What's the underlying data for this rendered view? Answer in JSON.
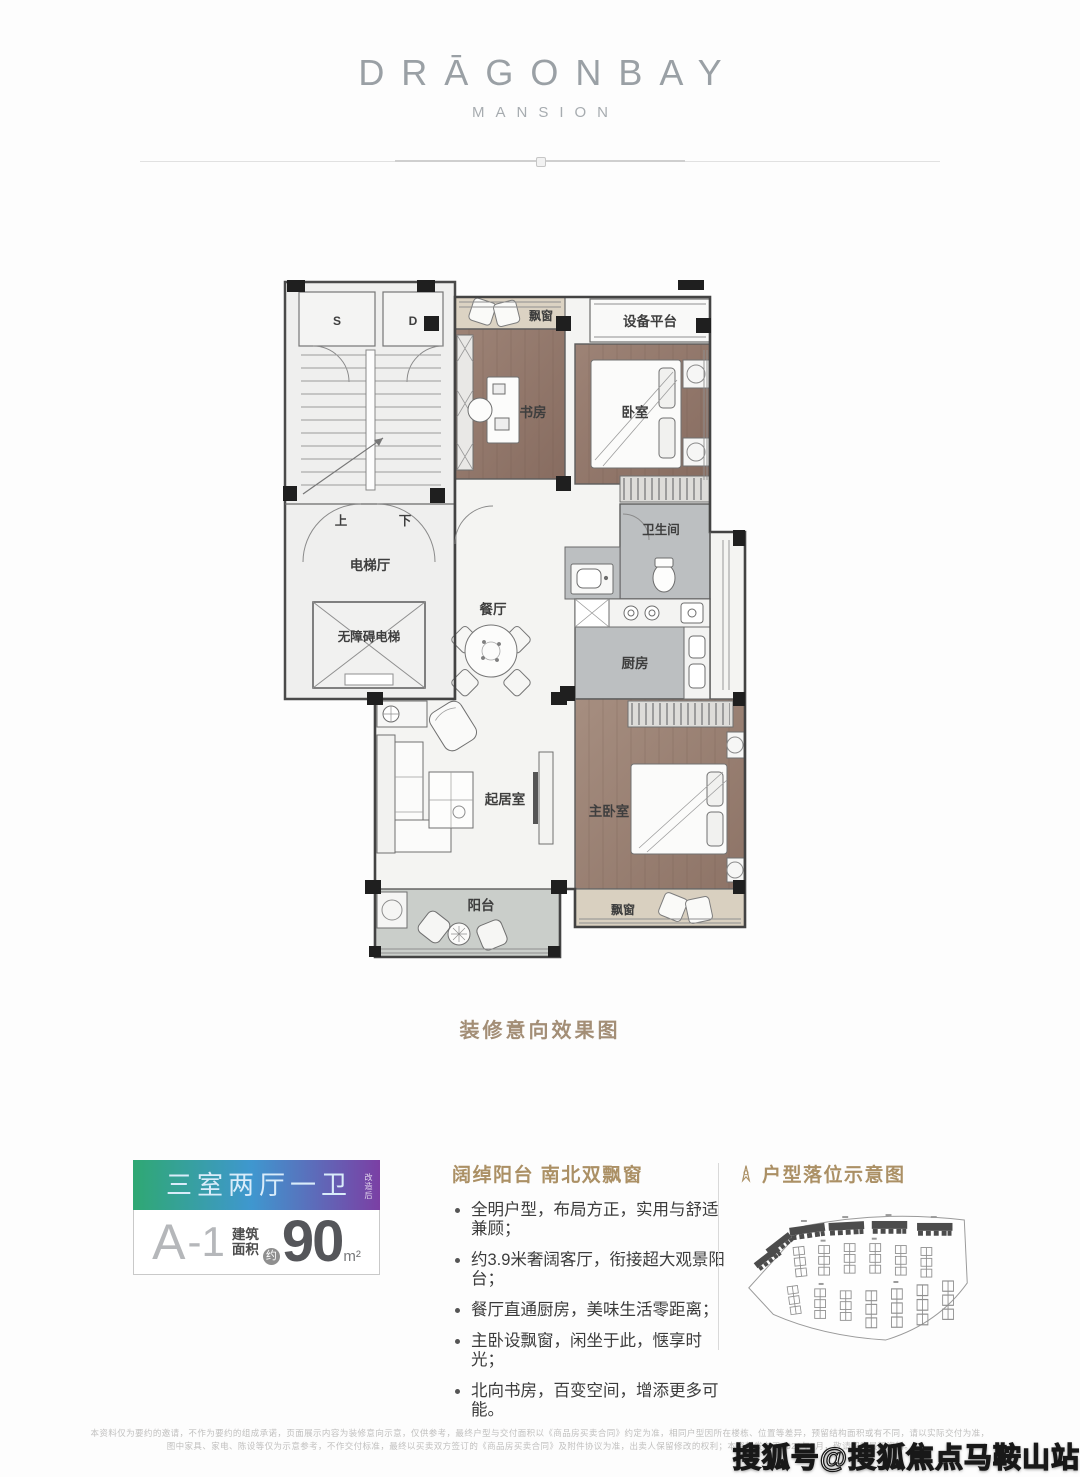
{
  "brand": {
    "title": "DRĀGONBAY",
    "subtitle": "MANSION"
  },
  "floorplan": {
    "caption": "装修意向效果图",
    "labels": {
      "s": "S",
      "d": "D",
      "up": "上",
      "down": "下",
      "elevator_hall": "电梯厅",
      "accessible_elevator": "无障碍电梯",
      "dining": "餐厅",
      "bathroom": "卫生间",
      "kitchen": "厨房",
      "study": "书房",
      "bedroom": "卧室",
      "equipment_platform": "设备平台",
      "bay_window_top": "飘窗",
      "living": "起居室",
      "master_bedroom": "主卧室",
      "balcony": "阳台",
      "bay_window_bottom": "飘窗"
    }
  },
  "unit_card": {
    "layout": "三室两厅一卫",
    "layout_note": "改造后",
    "unit_letter": "A",
    "unit_number": "-1",
    "area_label_line1": "建筑",
    "area_label_line2": "面积",
    "approx": "约",
    "area_value": "90",
    "area_unit": "m²",
    "gradient": {
      "left": "#2fa873",
      "mid": "#3f97cf",
      "right": "#7b3fa4"
    }
  },
  "features": {
    "heading": "阔绰阳台 南北双飘窗",
    "bullets": [
      "全明户型，布局方正，实用与舒适兼顾；",
      "约3.9米奢阔客厅，衔接超大观景阳台；",
      "餐厅直通厨房，美味生活零距离；",
      "主卧设飘窗，闲坐于此，惬享时光；",
      "北向书房，百变空间，增添更多可能。"
    ]
  },
  "siteplan": {
    "heading": "户型落位示意图"
  },
  "footer": {
    "disclaimer_line1": "本资料仅为要约的邀请，不作为要约的组成承诺，页面展示内容为装修意向示意，仅供参考，最终户型与交付面积以《商品房买卖合同》约定为准，相同户型因所在楼栋、位置等差异，预留结构面积或有不同，请以实际交付为准，",
    "disclaimer_line2": "图中家具、家电、陈设等仅为示意参考，不作交付标准，最终以买卖双方签订的《商品房买卖合同》及附件协议为准，出卖人保留修改的权利；本资料发布于2020年7月，敬请留意最新资料。",
    "watermark": "搜狐号@搜狐焦点马鞍山站"
  },
  "accent_colors": {
    "heading_tan": "#ab9065",
    "caption_tan": "#a38e76"
  }
}
